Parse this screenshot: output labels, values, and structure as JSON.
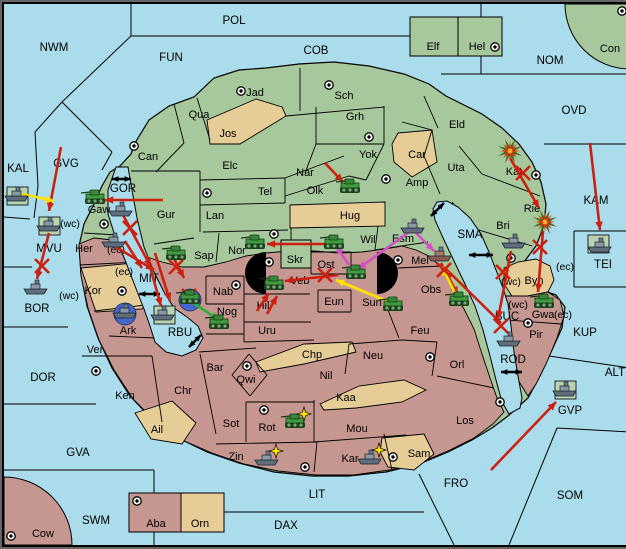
{
  "map": {
    "colors": {
      "sea": "#aadcec",
      "land_green": "#a6c89c",
      "land_tan": "#e6cc96",
      "land_mauve": "#c69690",
      "unit_square": "#b9d3b0",
      "convoy_circle": "#4566cc",
      "arrow_red": "#cc2010",
      "arrow_yellow": "#ffe400",
      "arrow_magenta": "#d44fc8",
      "arrow_green": "#2fae3a"
    },
    "sea_labels": [
      {
        "text": "POL",
        "x": 230,
        "y": 17
      },
      {
        "text": "NWM",
        "x": 50,
        "y": 44
      },
      {
        "text": "COB",
        "x": 312,
        "y": 47
      },
      {
        "text": "FUN",
        "x": 167,
        "y": 54
      },
      {
        "text": "NOM",
        "x": 546,
        "y": 57
      },
      {
        "text": "OVD",
        "x": 570,
        "y": 107
      },
      {
        "text": "GVG",
        "x": 62,
        "y": 160
      },
      {
        "text": "KAL",
        "x": 14,
        "y": 165
      },
      {
        "text": "GOR",
        "x": 119,
        "y": 185
      },
      {
        "text": "KAM",
        "x": 592,
        "y": 197
      },
      {
        "text": "MVU",
        "x": 45,
        "y": 245
      },
      {
        "text": "SMA",
        "x": 466,
        "y": 231
      },
      {
        "text": "MIT",
        "x": 145,
        "y": 275
      },
      {
        "text": "TEI",
        "x": 599,
        "y": 261
      },
      {
        "text": "RBU",
        "x": 176,
        "y": 329
      },
      {
        "text": "BOR",
        "x": 33,
        "y": 305
      },
      {
        "text": "BUC",
        "x": 503,
        "y": 313
      },
      {
        "text": "KUP",
        "x": 581,
        "y": 329
      },
      {
        "text": "ROD",
        "x": 509,
        "y": 356
      },
      {
        "text": "ALT",
        "x": 611,
        "y": 369
      },
      {
        "text": "DOR",
        "x": 39,
        "y": 374
      },
      {
        "text": "GVA",
        "x": 74,
        "y": 449
      },
      {
        "text": "GVP",
        "x": 566,
        "y": 407
      },
      {
        "text": "SWM",
        "x": 92,
        "y": 517
      },
      {
        "text": "LIT",
        "x": 313,
        "y": 491
      },
      {
        "text": "DAX",
        "x": 282,
        "y": 522
      },
      {
        "text": "FRO",
        "x": 452,
        "y": 480
      },
      {
        "text": "SOM",
        "x": 566,
        "y": 492
      }
    ],
    "region_labels": [
      {
        "text": "Elf",
        "x": 429,
        "y": 43
      },
      {
        "text": "Hel",
        "x": 473,
        "y": 43
      },
      {
        "text": "Con",
        "x": 606,
        "y": 45
      },
      {
        "text": "Jad",
        "x": 251,
        "y": 89
      },
      {
        "text": "Sch",
        "x": 340,
        "y": 92
      },
      {
        "text": "Qua",
        "x": 195,
        "y": 111
      },
      {
        "text": "Grh",
        "x": 351,
        "y": 113
      },
      {
        "text": "Eld",
        "x": 453,
        "y": 121
      },
      {
        "text": "Jos",
        "x": 224,
        "y": 130
      },
      {
        "text": "Can",
        "x": 144,
        "y": 153
      },
      {
        "text": "Yok",
        "x": 364,
        "y": 151
      },
      {
        "text": "Car",
        "x": 413,
        "y": 151
      },
      {
        "text": "Elc",
        "x": 226,
        "y": 162
      },
      {
        "text": "Nar",
        "x": 301,
        "y": 169
      },
      {
        "text": "Uta",
        "x": 452,
        "y": 164
      },
      {
        "text": "Kat",
        "x": 510,
        "y": 168
      },
      {
        "text": "Amp",
        "x": 413,
        "y": 179
      },
      {
        "text": "Tel",
        "x": 261,
        "y": 188
      },
      {
        "text": "Olk",
        "x": 311,
        "y": 187
      },
      {
        "text": "Gur",
        "x": 162,
        "y": 211
      },
      {
        "text": "Lan",
        "x": 211,
        "y": 212
      },
      {
        "text": "Hug",
        "x": 346,
        "y": 212
      },
      {
        "text": "Rie",
        "x": 528,
        "y": 205
      },
      {
        "text": "Gaw",
        "x": 95,
        "y": 206
      },
      {
        "text": "Bri",
        "x": 499,
        "y": 222
      },
      {
        "text": "Wil",
        "x": 364,
        "y": 236
      },
      {
        "text": "Esm",
        "x": 399,
        "y": 235
      },
      {
        "text": "Her",
        "x": 80,
        "y": 245
      },
      {
        "text": "Nor",
        "x": 233,
        "y": 247
      },
      {
        "text": "Sap",
        "x": 200,
        "y": 252
      },
      {
        "text": "Skr",
        "x": 291,
        "y": 256
      },
      {
        "text": "Ost",
        "x": 322,
        "y": 261
      },
      {
        "text": "Mel",
        "x": 416,
        "y": 257
      },
      {
        "text": "Veb",
        "x": 296,
        "y": 277
      },
      {
        "text": "Byn",
        "x": 530,
        "y": 277
      },
      {
        "text": "Kor",
        "x": 89,
        "y": 287
      },
      {
        "text": "Eun",
        "x": 330,
        "y": 298
      },
      {
        "text": "Sun",
        "x": 368,
        "y": 299
      },
      {
        "text": "Obs",
        "x": 427,
        "y": 286
      },
      {
        "text": "Hil",
        "x": 259,
        "y": 302
      },
      {
        "text": "Nab",
        "x": 219,
        "y": 288
      },
      {
        "text": "Nog",
        "x": 223,
        "y": 308
      },
      {
        "text": "Gwa",
        "x": 539,
        "y": 311
      },
      {
        "text": "Pir",
        "x": 532,
        "y": 331
      },
      {
        "text": "Uru",
        "x": 263,
        "y": 327
      },
      {
        "text": "Ark",
        "x": 124,
        "y": 327
      },
      {
        "text": "Ver",
        "x": 91,
        "y": 346
      },
      {
        "text": "Bar",
        "x": 211,
        "y": 364
      },
      {
        "text": "Qwi",
        "x": 242,
        "y": 376
      },
      {
        "text": "Chp",
        "x": 308,
        "y": 351
      },
      {
        "text": "Nil",
        "x": 322,
        "y": 372
      },
      {
        "text": "Neu",
        "x": 369,
        "y": 352
      },
      {
        "text": "Feu",
        "x": 416,
        "y": 327
      },
      {
        "text": "Orl",
        "x": 453,
        "y": 361
      },
      {
        "text": "Ken",
        "x": 121,
        "y": 392
      },
      {
        "text": "Chr",
        "x": 179,
        "y": 387
      },
      {
        "text": "Kaa",
        "x": 342,
        "y": 394
      },
      {
        "text": "Sot",
        "x": 227,
        "y": 420
      },
      {
        "text": "Rot",
        "x": 263,
        "y": 424
      },
      {
        "text": "Mou",
        "x": 353,
        "y": 425
      },
      {
        "text": "Los",
        "x": 461,
        "y": 417
      },
      {
        "text": "Ail",
        "x": 153,
        "y": 426
      },
      {
        "text": "Zin",
        "x": 232,
        "y": 453
      },
      {
        "text": "Kar",
        "x": 346,
        "y": 455
      },
      {
        "text": "Sam",
        "x": 415,
        "y": 450
      },
      {
        "text": "Cow",
        "x": 39,
        "y": 530
      },
      {
        "text": "Aba",
        "x": 152,
        "y": 520
      },
      {
        "text": "Orn",
        "x": 196,
        "y": 520
      }
    ],
    "coast_annotations": [
      {
        "text": "(wc)",
        "x": 66,
        "y": 220
      },
      {
        "text": "(ec)",
        "x": 112,
        "y": 246
      },
      {
        "text": "(ec)",
        "x": 120,
        "y": 268
      },
      {
        "text": "(wc)",
        "x": 65,
        "y": 292
      },
      {
        "text": "(ec)",
        "x": 561,
        "y": 263
      },
      {
        "text": "(wc)",
        "x": 507,
        "y": 278
      },
      {
        "text": "(wc)",
        "x": 514,
        "y": 301
      },
      {
        "text": "(ec)",
        "x": 559,
        "y": 311
      }
    ],
    "supply_centers": [
      {
        "x": 237,
        "y": 87
      },
      {
        "x": 325,
        "y": 81
      },
      {
        "x": 365,
        "y": 133
      },
      {
        "x": 130,
        "y": 142
      },
      {
        "x": 203,
        "y": 189
      },
      {
        "x": 382,
        "y": 175
      },
      {
        "x": 270,
        "y": 230
      },
      {
        "x": 100,
        "y": 220
      },
      {
        "x": 491,
        "y": 43
      },
      {
        "x": 618,
        "y": 7
      },
      {
        "x": 532,
        "y": 171
      },
      {
        "x": 507,
        "y": 254
      },
      {
        "x": 394,
        "y": 256
      },
      {
        "x": 265,
        "y": 258
      },
      {
        "x": 232,
        "y": 281
      },
      {
        "x": 118,
        "y": 287
      },
      {
        "x": 92,
        "y": 367
      },
      {
        "x": 243,
        "y": 362
      },
      {
        "x": 260,
        "y": 406
      },
      {
        "x": 426,
        "y": 353
      },
      {
        "x": 496,
        "y": 398
      },
      {
        "x": 301,
        "y": 463
      },
      {
        "x": 389,
        "y": 453
      },
      {
        "x": 524,
        "y": 319
      },
      {
        "x": 133,
        "y": 497
      },
      {
        "x": 7,
        "y": 532
      }
    ],
    "units": [
      {
        "type": "fleet",
        "x": 13,
        "y": 191,
        "bg": "square"
      },
      {
        "type": "fleet",
        "x": 45,
        "y": 221,
        "bg": "square"
      },
      {
        "type": "fleet",
        "x": 117,
        "y": 206
      },
      {
        "type": "fleet",
        "x": 110,
        "y": 237
      },
      {
        "type": "fleet",
        "x": 32,
        "y": 284
      },
      {
        "type": "fleet",
        "x": 121,
        "y": 308,
        "bg": "circle"
      },
      {
        "type": "fleet",
        "x": 159,
        "y": 310,
        "bg": "square"
      },
      {
        "type": "fleet",
        "x": 409,
        "y": 223
      },
      {
        "type": "fleet",
        "x": 436,
        "y": 251,
        "tint": "red"
      },
      {
        "type": "fleet",
        "x": 510,
        "y": 238
      },
      {
        "type": "fleet",
        "x": 505,
        "y": 336
      },
      {
        "type": "fleet",
        "x": 596,
        "y": 242,
        "bg": "square"
      },
      {
        "type": "fleet",
        "x": 561,
        "y": 386,
        "bg": "square"
      },
      {
        "type": "fleet",
        "x": 263,
        "y": 455,
        "star": true
      },
      {
        "type": "fleet",
        "x": 366,
        "y": 454,
        "star": true
      },
      {
        "type": "army",
        "x": 91,
        "y": 194
      },
      {
        "type": "army",
        "x": 346,
        "y": 183
      },
      {
        "type": "army",
        "x": 251,
        "y": 239
      },
      {
        "type": "army",
        "x": 172,
        "y": 250
      },
      {
        "type": "army",
        "x": 330,
        "y": 239
      },
      {
        "type": "army",
        "x": 352,
        "y": 269
      },
      {
        "type": "army",
        "x": 270,
        "y": 280
      },
      {
        "type": "army",
        "x": 389,
        "y": 301
      },
      {
        "type": "army",
        "x": 455,
        "y": 296
      },
      {
        "type": "army",
        "x": 540,
        "y": 298
      },
      {
        "type": "army",
        "x": 215,
        "y": 319
      },
      {
        "type": "army",
        "x": 186,
        "y": 294,
        "bg": "circle"
      },
      {
        "type": "army",
        "x": 291,
        "y": 418,
        "star": true
      }
    ],
    "explosions": [
      {
        "x": 506,
        "y": 147
      },
      {
        "x": 541,
        "y": 218
      }
    ],
    "double_arrows": [
      {
        "x1": 108,
        "y1": 175,
        "x2": 127,
        "y2": 175
      },
      {
        "x1": 135,
        "y1": 290,
        "x2": 156,
        "y2": 290
      },
      {
        "x1": 185,
        "y1": 343,
        "x2": 197,
        "y2": 331
      },
      {
        "x1": 427,
        "y1": 212,
        "x2": 440,
        "y2": 199
      },
      {
        "x1": 465,
        "y1": 251,
        "x2": 489,
        "y2": 251
      },
      {
        "x1": 497,
        "y1": 368,
        "x2": 518,
        "y2": 368
      }
    ],
    "move_arrows": [
      {
        "color": "red",
        "x1": 57,
        "y1": 143,
        "x2": 45,
        "y2": 207
      },
      {
        "color": "red",
        "x1": 159,
        "y1": 196,
        "x2": 101,
        "y2": 196
      },
      {
        "color": "red",
        "x1": 119,
        "y1": 211,
        "x2": 147,
        "y2": 263
      },
      {
        "color": "red",
        "x1": 121,
        "y1": 237,
        "x2": 138,
        "y2": 264
      },
      {
        "color": "red",
        "x1": 45,
        "y1": 229,
        "x2": 33,
        "y2": 275
      },
      {
        "color": "red",
        "x1": 112,
        "y1": 243,
        "x2": 150,
        "y2": 266
      },
      {
        "color": "red",
        "x1": 143,
        "y1": 252,
        "x2": 157,
        "y2": 302
      },
      {
        "color": "red",
        "x1": 151,
        "y1": 249,
        "x2": 166,
        "y2": 297
      },
      {
        "color": "red",
        "x1": 166,
        "y1": 247,
        "x2": 180,
        "y2": 274
      },
      {
        "color": "red",
        "x1": 322,
        "y1": 240,
        "x2": 263,
        "y2": 240
      },
      {
        "color": "red",
        "x1": 321,
        "y1": 159,
        "x2": 339,
        "y2": 178
      },
      {
        "color": "red",
        "x1": 334,
        "y1": 271,
        "x2": 281,
        "y2": 277
      },
      {
        "color": "red",
        "x1": 253,
        "y1": 307,
        "x2": 265,
        "y2": 289
      },
      {
        "color": "red",
        "x1": 263,
        "y1": 310,
        "x2": 273,
        "y2": 292
      },
      {
        "color": "red",
        "x1": 437,
        "y1": 259,
        "x2": 454,
        "y2": 291
      },
      {
        "color": "red",
        "x1": 441,
        "y1": 264,
        "x2": 497,
        "y2": 319
      },
      {
        "color": "red",
        "x1": 506,
        "y1": 154,
        "x2": 535,
        "y2": 204
      },
      {
        "color": "red",
        "x1": 539,
        "y1": 227,
        "x2": 534,
        "y2": 288
      },
      {
        "color": "red",
        "x1": 507,
        "y1": 247,
        "x2": 494,
        "y2": 315
      },
      {
        "color": "red",
        "x1": 586,
        "y1": 139,
        "x2": 596,
        "y2": 226
      },
      {
        "color": "red",
        "x1": 487,
        "y1": 466,
        "x2": 552,
        "y2": 398
      },
      {
        "color": "yellow",
        "x1": 18,
        "y1": 190,
        "x2": 50,
        "y2": 197
      },
      {
        "color": "yellow",
        "x1": 385,
        "y1": 298,
        "x2": 332,
        "y2": 276
      },
      {
        "color": "yellow",
        "x1": 452,
        "y1": 291,
        "x2": 438,
        "y2": 263
      },
      {
        "color": "magenta",
        "x1": 405,
        "y1": 228,
        "x2": 354,
        "y2": 265
      },
      {
        "color": "magenta",
        "x1": 345,
        "y1": 261,
        "x2": 332,
        "y2": 242
      },
      {
        "color": "magenta",
        "x1": 412,
        "y1": 229,
        "x2": 430,
        "y2": 247
      },
      {
        "color": "green",
        "x1": 176,
        "y1": 290,
        "x2": 215,
        "y2": 316
      }
    ],
    "x_marks": [
      {
        "x": 126,
        "y": 224
      },
      {
        "x": 38,
        "y": 262
      },
      {
        "x": 172,
        "y": 263
      },
      {
        "x": 185,
        "y": 292
      },
      {
        "x": 321,
        "y": 271
      },
      {
        "x": 440,
        "y": 266
      },
      {
        "x": 497,
        "y": 322
      },
      {
        "x": 519,
        "y": 169
      },
      {
        "x": 536,
        "y": 243
      },
      {
        "x": 499,
        "y": 268
      }
    ]
  }
}
